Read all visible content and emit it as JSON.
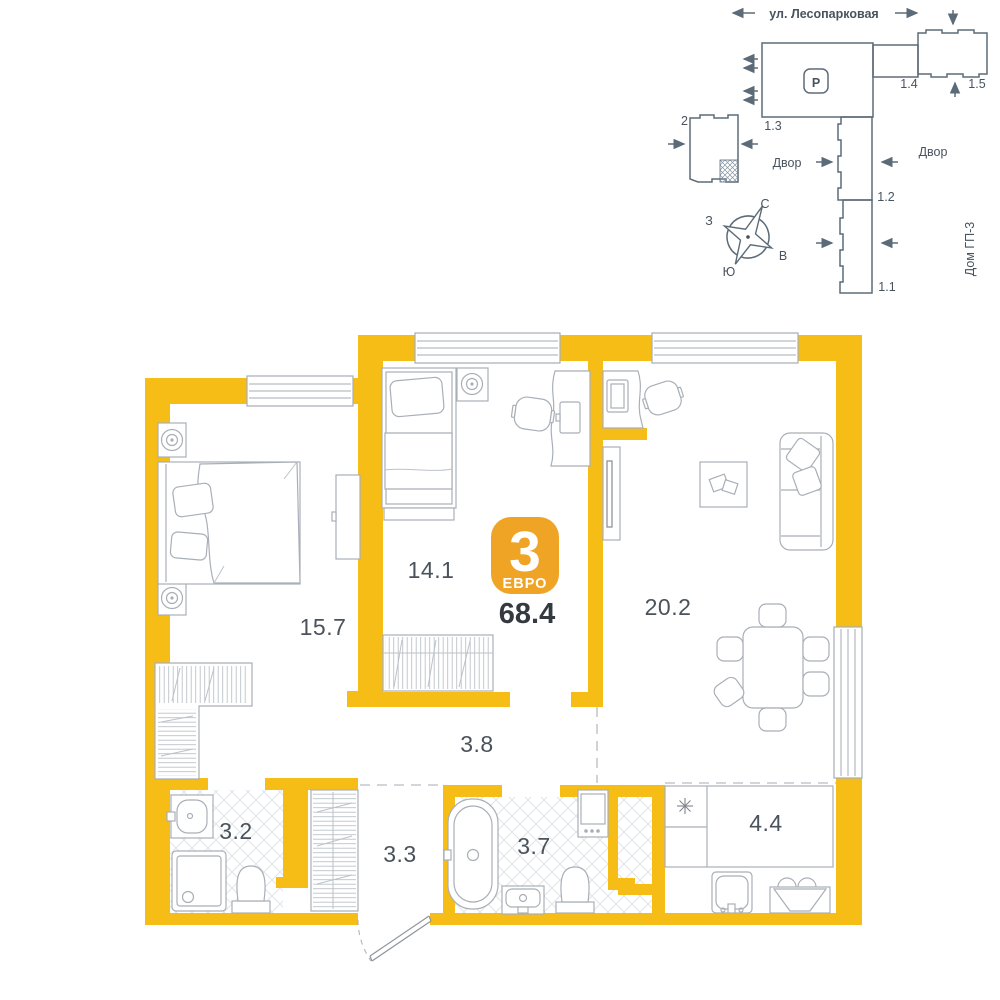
{
  "site_plan": {
    "street": "ул. Лесопарковая",
    "yards": {
      "left": "Двор",
      "right": "Двор"
    },
    "house": "Дом ГП-3",
    "parking_mark": "P",
    "buildings": {
      "b2": "2",
      "b11": "1.1",
      "b12": "1.2",
      "b13": "1.3",
      "b14": "1.4",
      "b15": "1.5"
    },
    "compass": {
      "n": "С",
      "s": "Ю",
      "w": "З",
      "e": "В"
    }
  },
  "apartment": {
    "badge": {
      "rooms": "3",
      "type": "ЕВРО"
    },
    "total_area": "68.4",
    "rooms": {
      "bedroom_1": "15.7",
      "bedroom_2": "14.1",
      "living_room": "20.2",
      "hallway": "3.8",
      "bathroom_1": "3.2",
      "closet": "3.3",
      "bathroom_2": "3.7",
      "kitchen": "4.4"
    },
    "colors": {
      "wall": "#F6BD17",
      "badge": "#EFA426",
      "site_plan_lines": "#5C6B78",
      "furniture_lines": "#A9AFB7"
    }
  }
}
